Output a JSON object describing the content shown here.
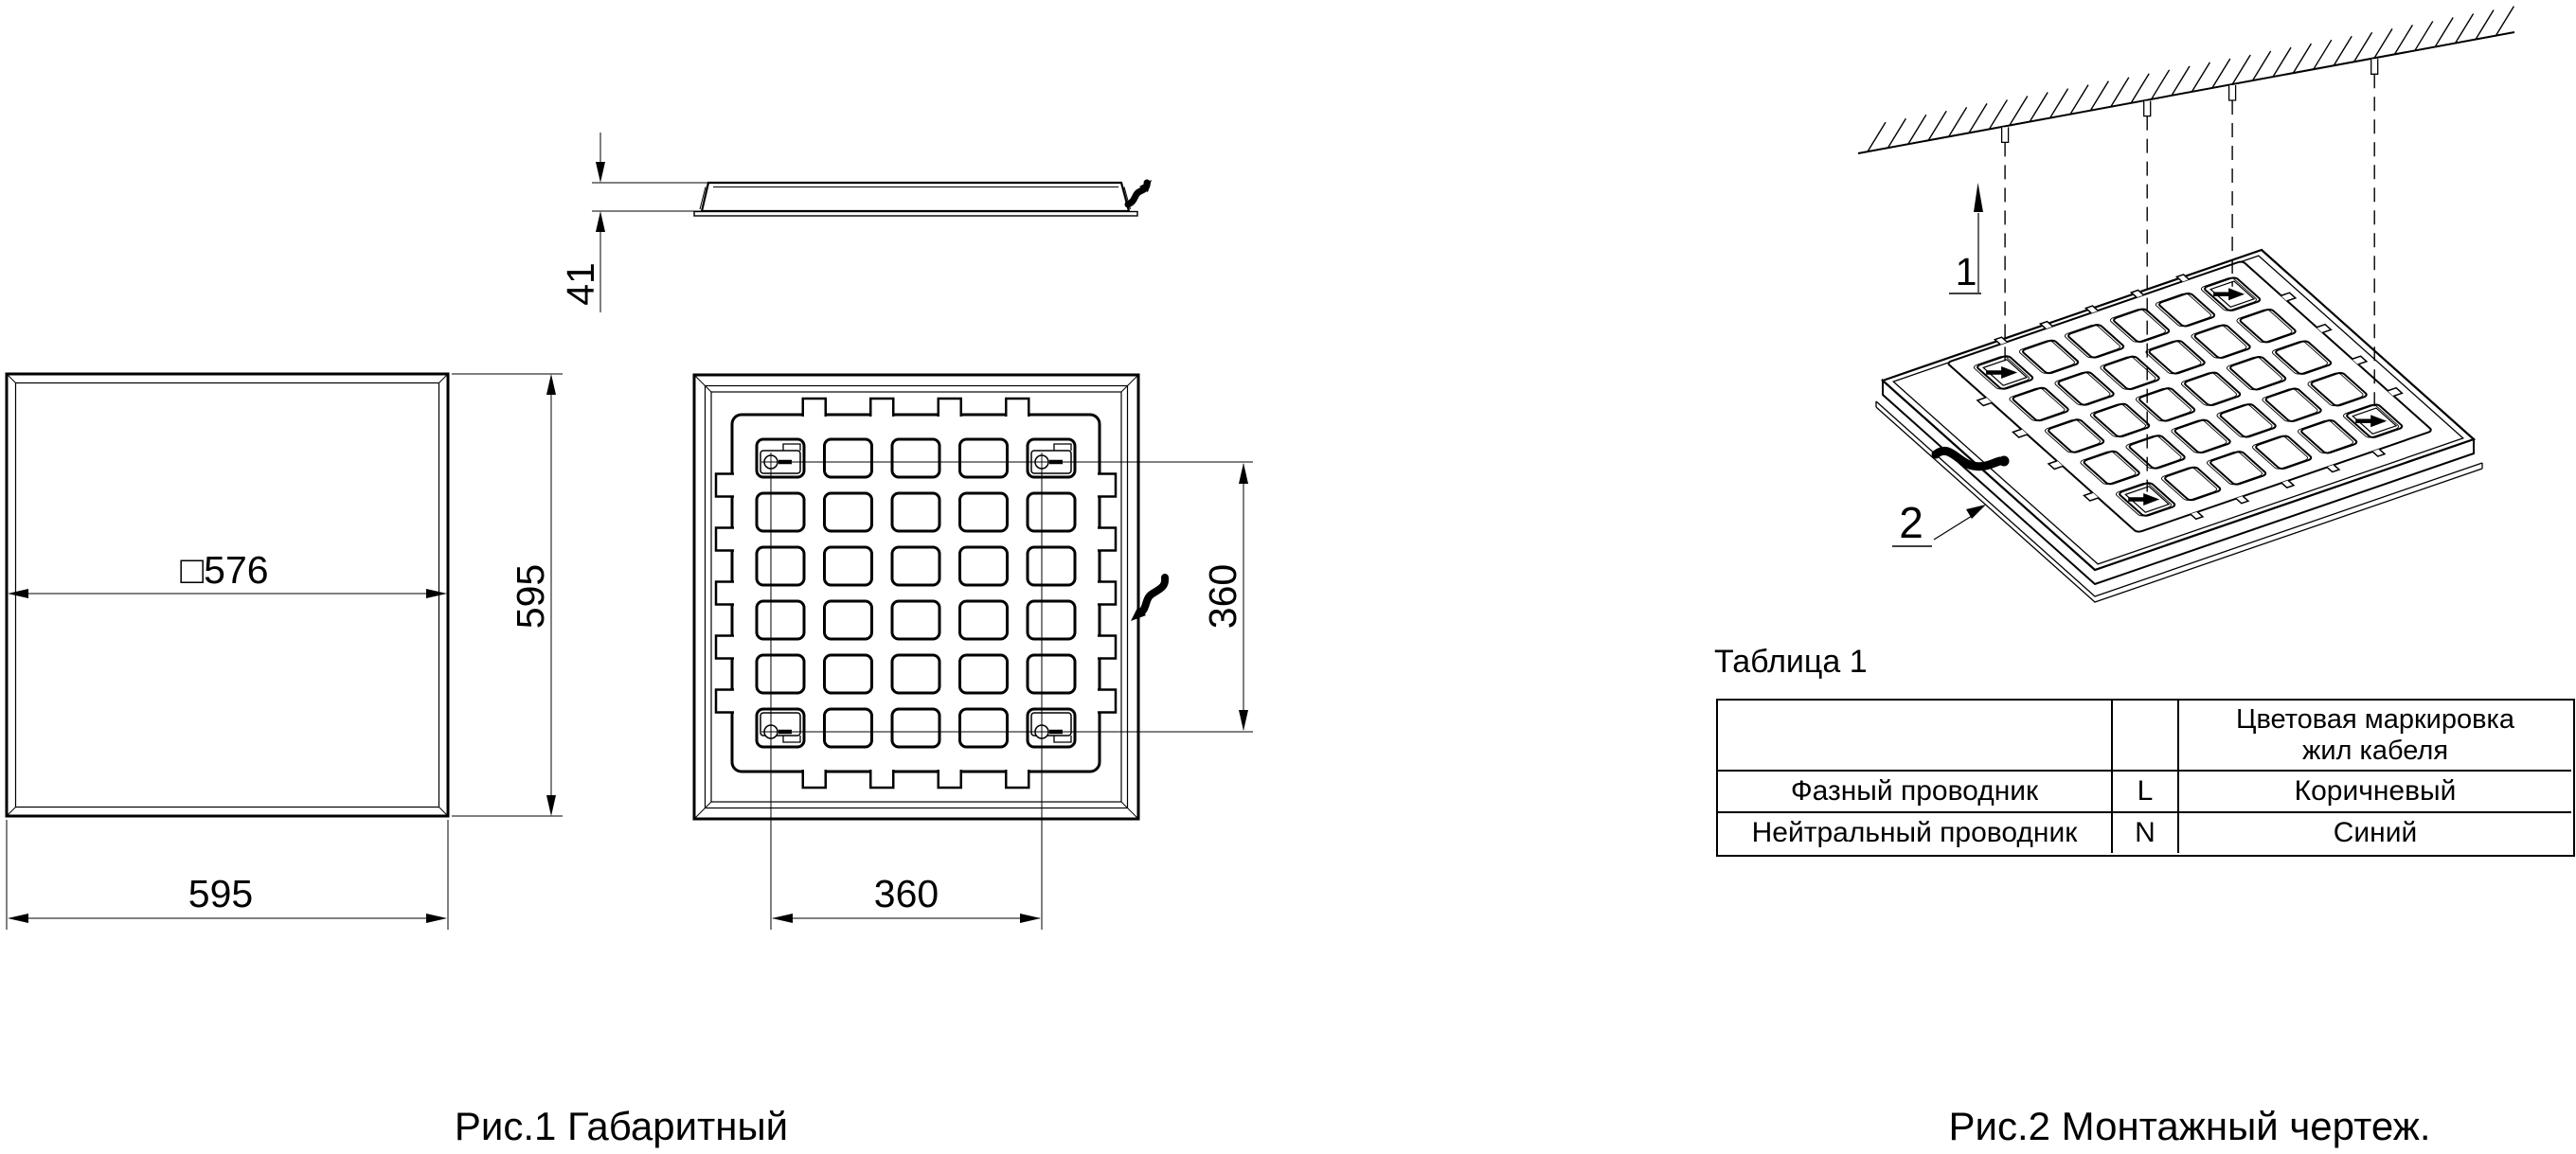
{
  "drawing": {
    "background": "#ffffff",
    "line_color": "#000000"
  },
  "figure1": {
    "caption": "Рис.1 Габаритный чертеж.",
    "front_view": {
      "inner_size": "□576",
      "height": "595",
      "width": "595"
    },
    "side_view": {
      "thickness": "41"
    },
    "back_view": {
      "mount_spacing_vertical": "360",
      "mount_spacing_horizontal": "360"
    }
  },
  "figure2": {
    "caption": "Рис.2 Монтажный чертеж.",
    "callout_ceiling_mount": "1",
    "callout_cable": "2"
  },
  "table": {
    "title": "Таблица 1",
    "header": {
      "marking_title_line1": "Цветовая маркировка",
      "marking_title_line2": "жил кабеля"
    },
    "rows": [
      {
        "name": "Фазный проводник",
        "code": "L",
        "color": "Коричневый"
      },
      {
        "name": "Нейтральный проводник",
        "code": "N",
        "color": "Синий"
      }
    ]
  }
}
